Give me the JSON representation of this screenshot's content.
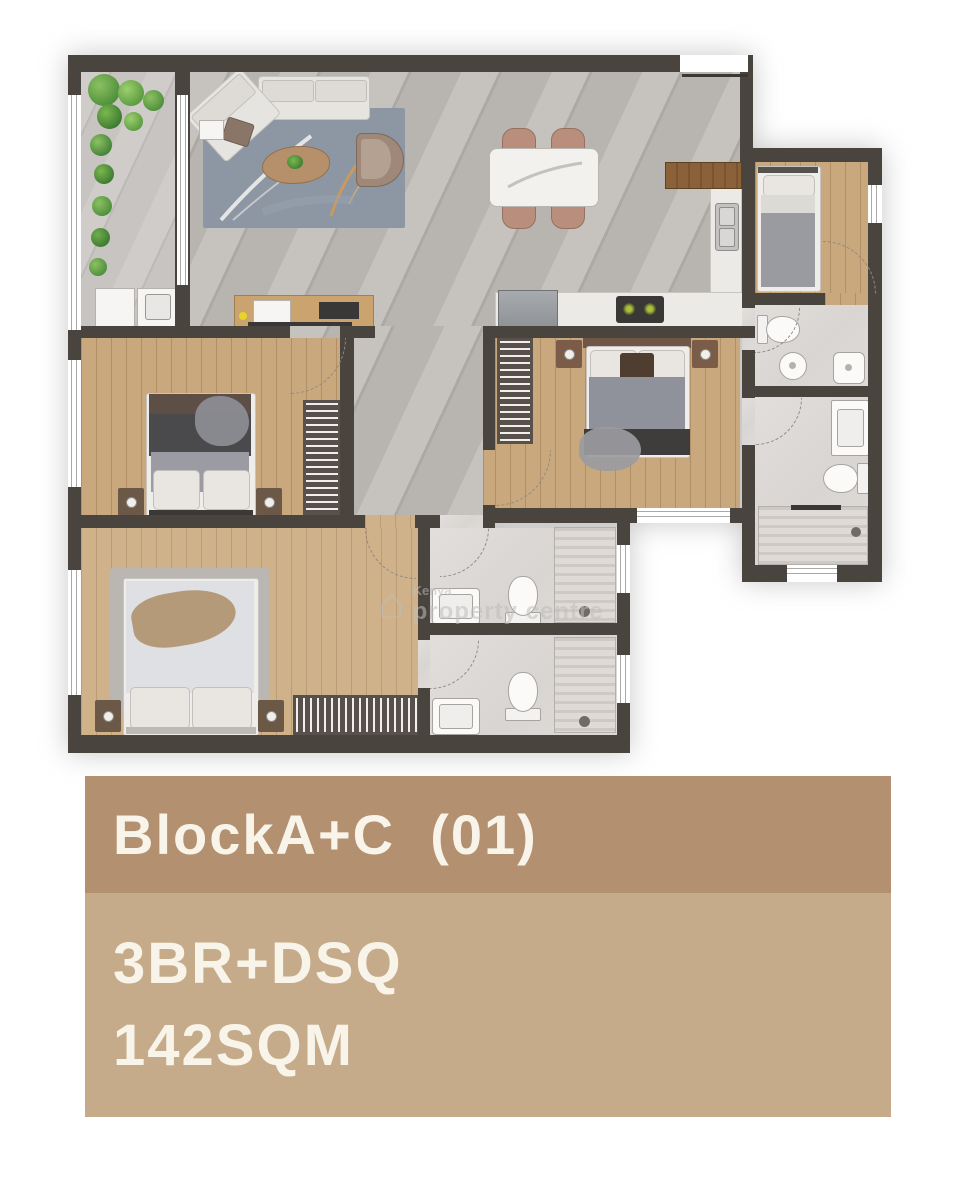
{
  "colors": {
    "wall": "#4a443f",
    "marble": "#b8b4af",
    "wood": "#c9a87d",
    "woodL": "#cfb18a",
    "balc": "#c7c4c1",
    "rug": "#8d96a3",
    "card-h": "#b29070",
    "card-b": "#c5ab89",
    "card-t": "#f9f4ea"
  },
  "watermark": {
    "icon": "house-icon",
    "line1": "Kenya",
    "line2": "property centre"
  },
  "card": {
    "title": "BlockA+C  (01)",
    "line1": "3BR+DSQ",
    "line2": "142SQM"
  }
}
